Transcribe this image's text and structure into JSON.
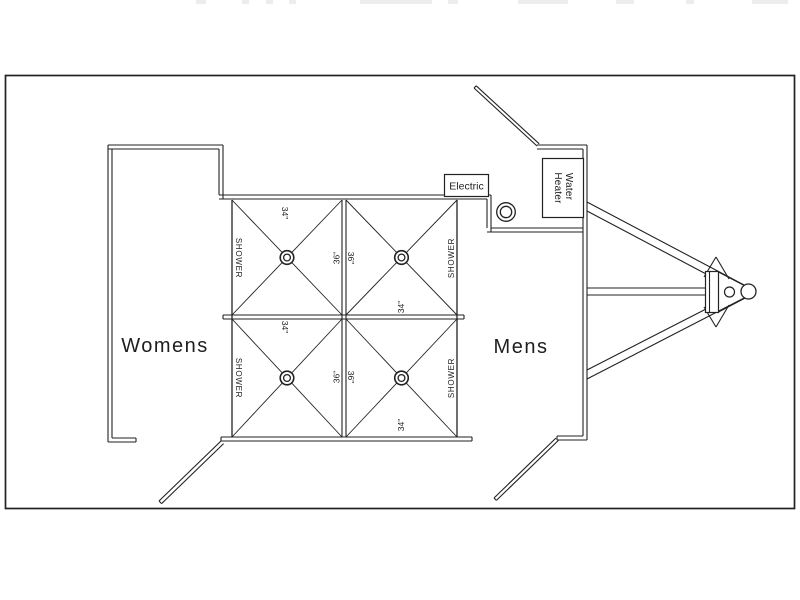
{
  "page": {
    "background": "#ffffff",
    "line_color": "#222222",
    "description": "CAD floor plan of a shower trailer"
  },
  "plan": {
    "womens_label": "Womens",
    "mens_label": "Mens",
    "electric_label": "Electric",
    "water_heater": {
      "line1": "Water",
      "line2": "Heater"
    },
    "stalls": [
      {
        "position": "top-left",
        "label": "SHOWER",
        "edge_dim": "34\"",
        "center_dim": "36\""
      },
      {
        "position": "top-right",
        "label": "SHOWER",
        "edge_dim": "34\"",
        "center_dim": "36\""
      },
      {
        "position": "bottom-left",
        "label": "SHOWER",
        "edge_dim": "34\"",
        "center_dim": "36\""
      },
      {
        "position": "bottom-right",
        "label": "SHOWER",
        "edge_dim": "34\"",
        "center_dim": "36\""
      }
    ]
  }
}
